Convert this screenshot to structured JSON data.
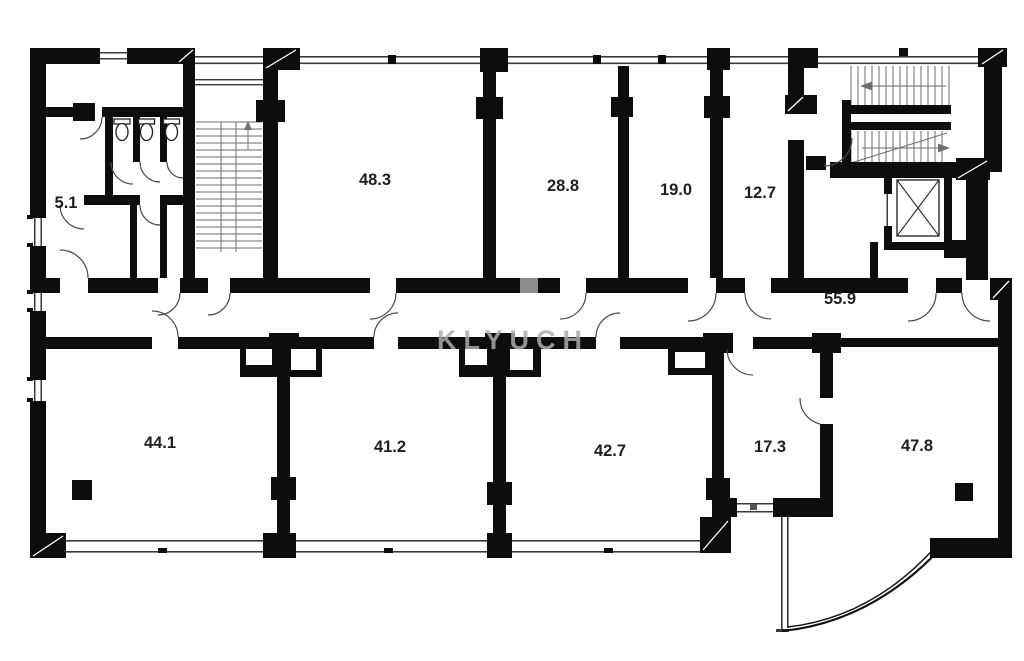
{
  "watermark": {
    "text": "KLYUCH"
  },
  "rooms": [
    {
      "id": "wc-block",
      "label": "5.1"
    },
    {
      "id": "office-top-1",
      "label": "48.3"
    },
    {
      "id": "office-top-2",
      "label": "28.8"
    },
    {
      "id": "office-top-3",
      "label": "19.0"
    },
    {
      "id": "office-top-4",
      "label": "12.7"
    },
    {
      "id": "corridor",
      "label": "55.9"
    },
    {
      "id": "office-bottom-1",
      "label": "44.1"
    },
    {
      "id": "office-bottom-2",
      "label": "41.2"
    },
    {
      "id": "office-bottom-3",
      "label": "42.7"
    },
    {
      "id": "office-bottom-4",
      "label": "17.3"
    },
    {
      "id": "office-bottom-5",
      "label": "47.8"
    }
  ],
  "colors": {
    "wall": "#0d0d0d",
    "background": "#ffffff",
    "label": "#1f1f1f",
    "watermark": "#ababab"
  }
}
